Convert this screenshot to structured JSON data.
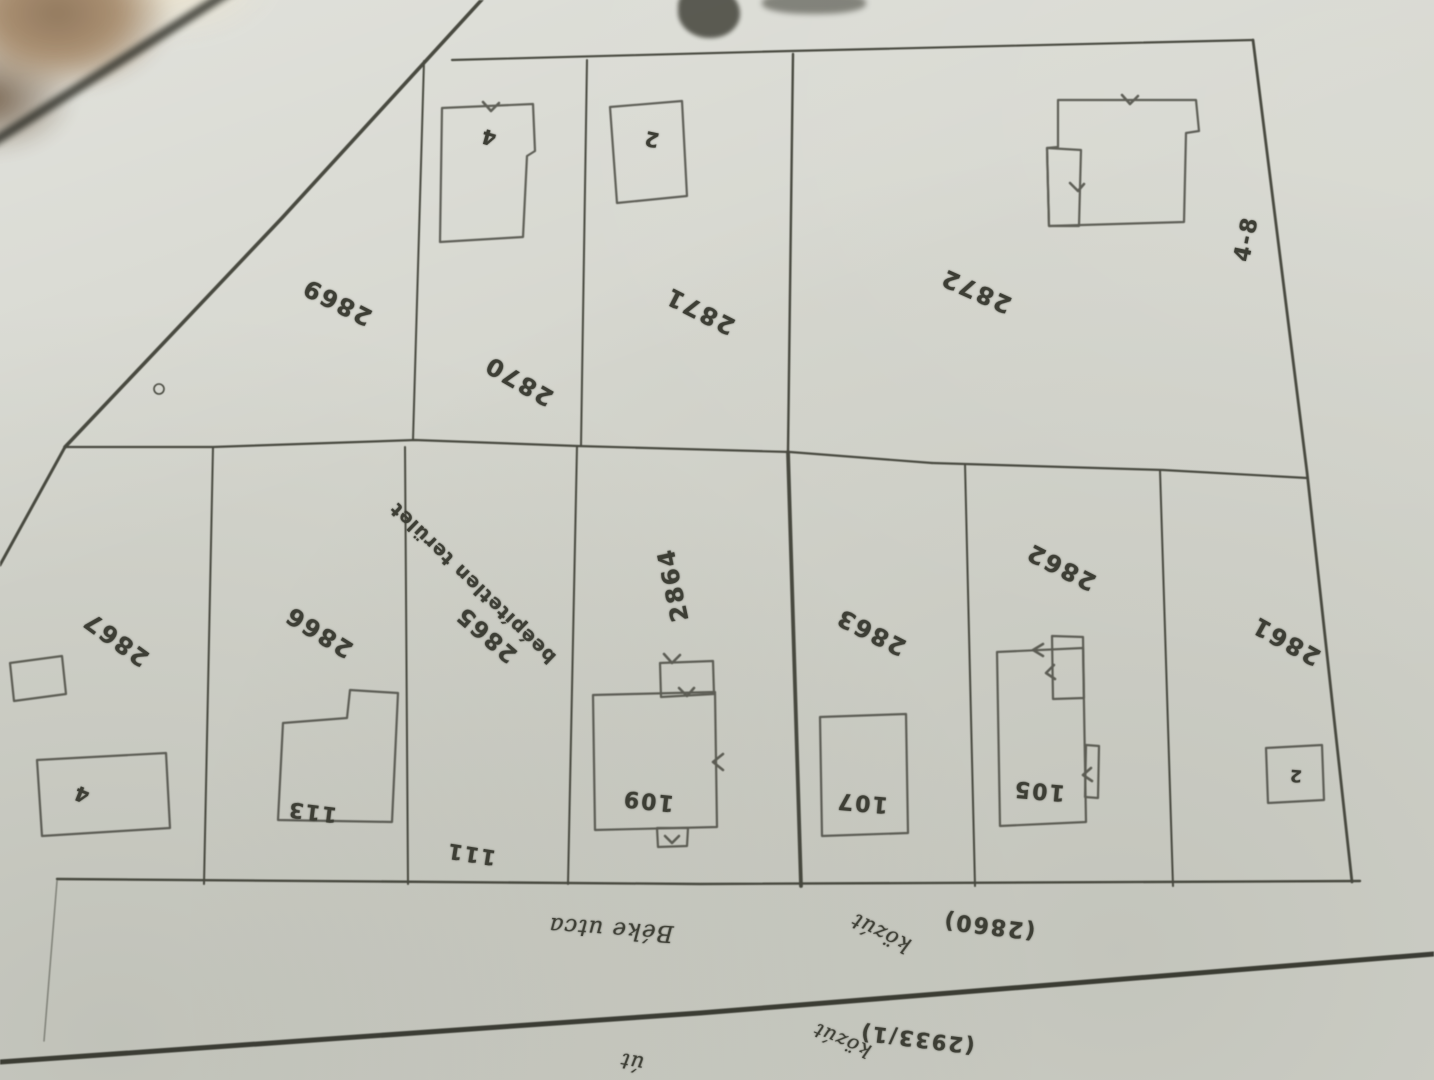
{
  "colors": {
    "paper": "#d5d6ce",
    "ink": "#3d3e35",
    "road_line": "#31322a",
    "corner_blur_brown": "#8e7357"
  },
  "map": {
    "orientation_note_text": "",
    "labels": {
      "parcels": {
        "p2869": "2869",
        "p2870": "2870",
        "p2871": "2871",
        "p2872": "2872",
        "p2867": "2867",
        "p2866": "2866",
        "p2865": "2865",
        "p2864": "2864",
        "p2863": "2863",
        "p2862": "2862",
        "p2861": "2861"
      },
      "notes": {
        "beepitetlen": "beépítetlen terület"
      },
      "houses": {
        "h4_top": "4",
        "h2_top": "2",
        "h48": "4-8",
        "h113": "113",
        "h111": "111",
        "h109": "109",
        "h107": "107",
        "h105": "105",
        "h4_left": "4",
        "h2_right": "2"
      },
      "streets": {
        "beke_utca": "Béke utca",
        "kozut_label": "közút",
        "kozut_number": "(2860)",
        "ut": "út",
        "kozut2_label": "közút",
        "kozut2_number": "(2933/1)"
      }
    }
  }
}
